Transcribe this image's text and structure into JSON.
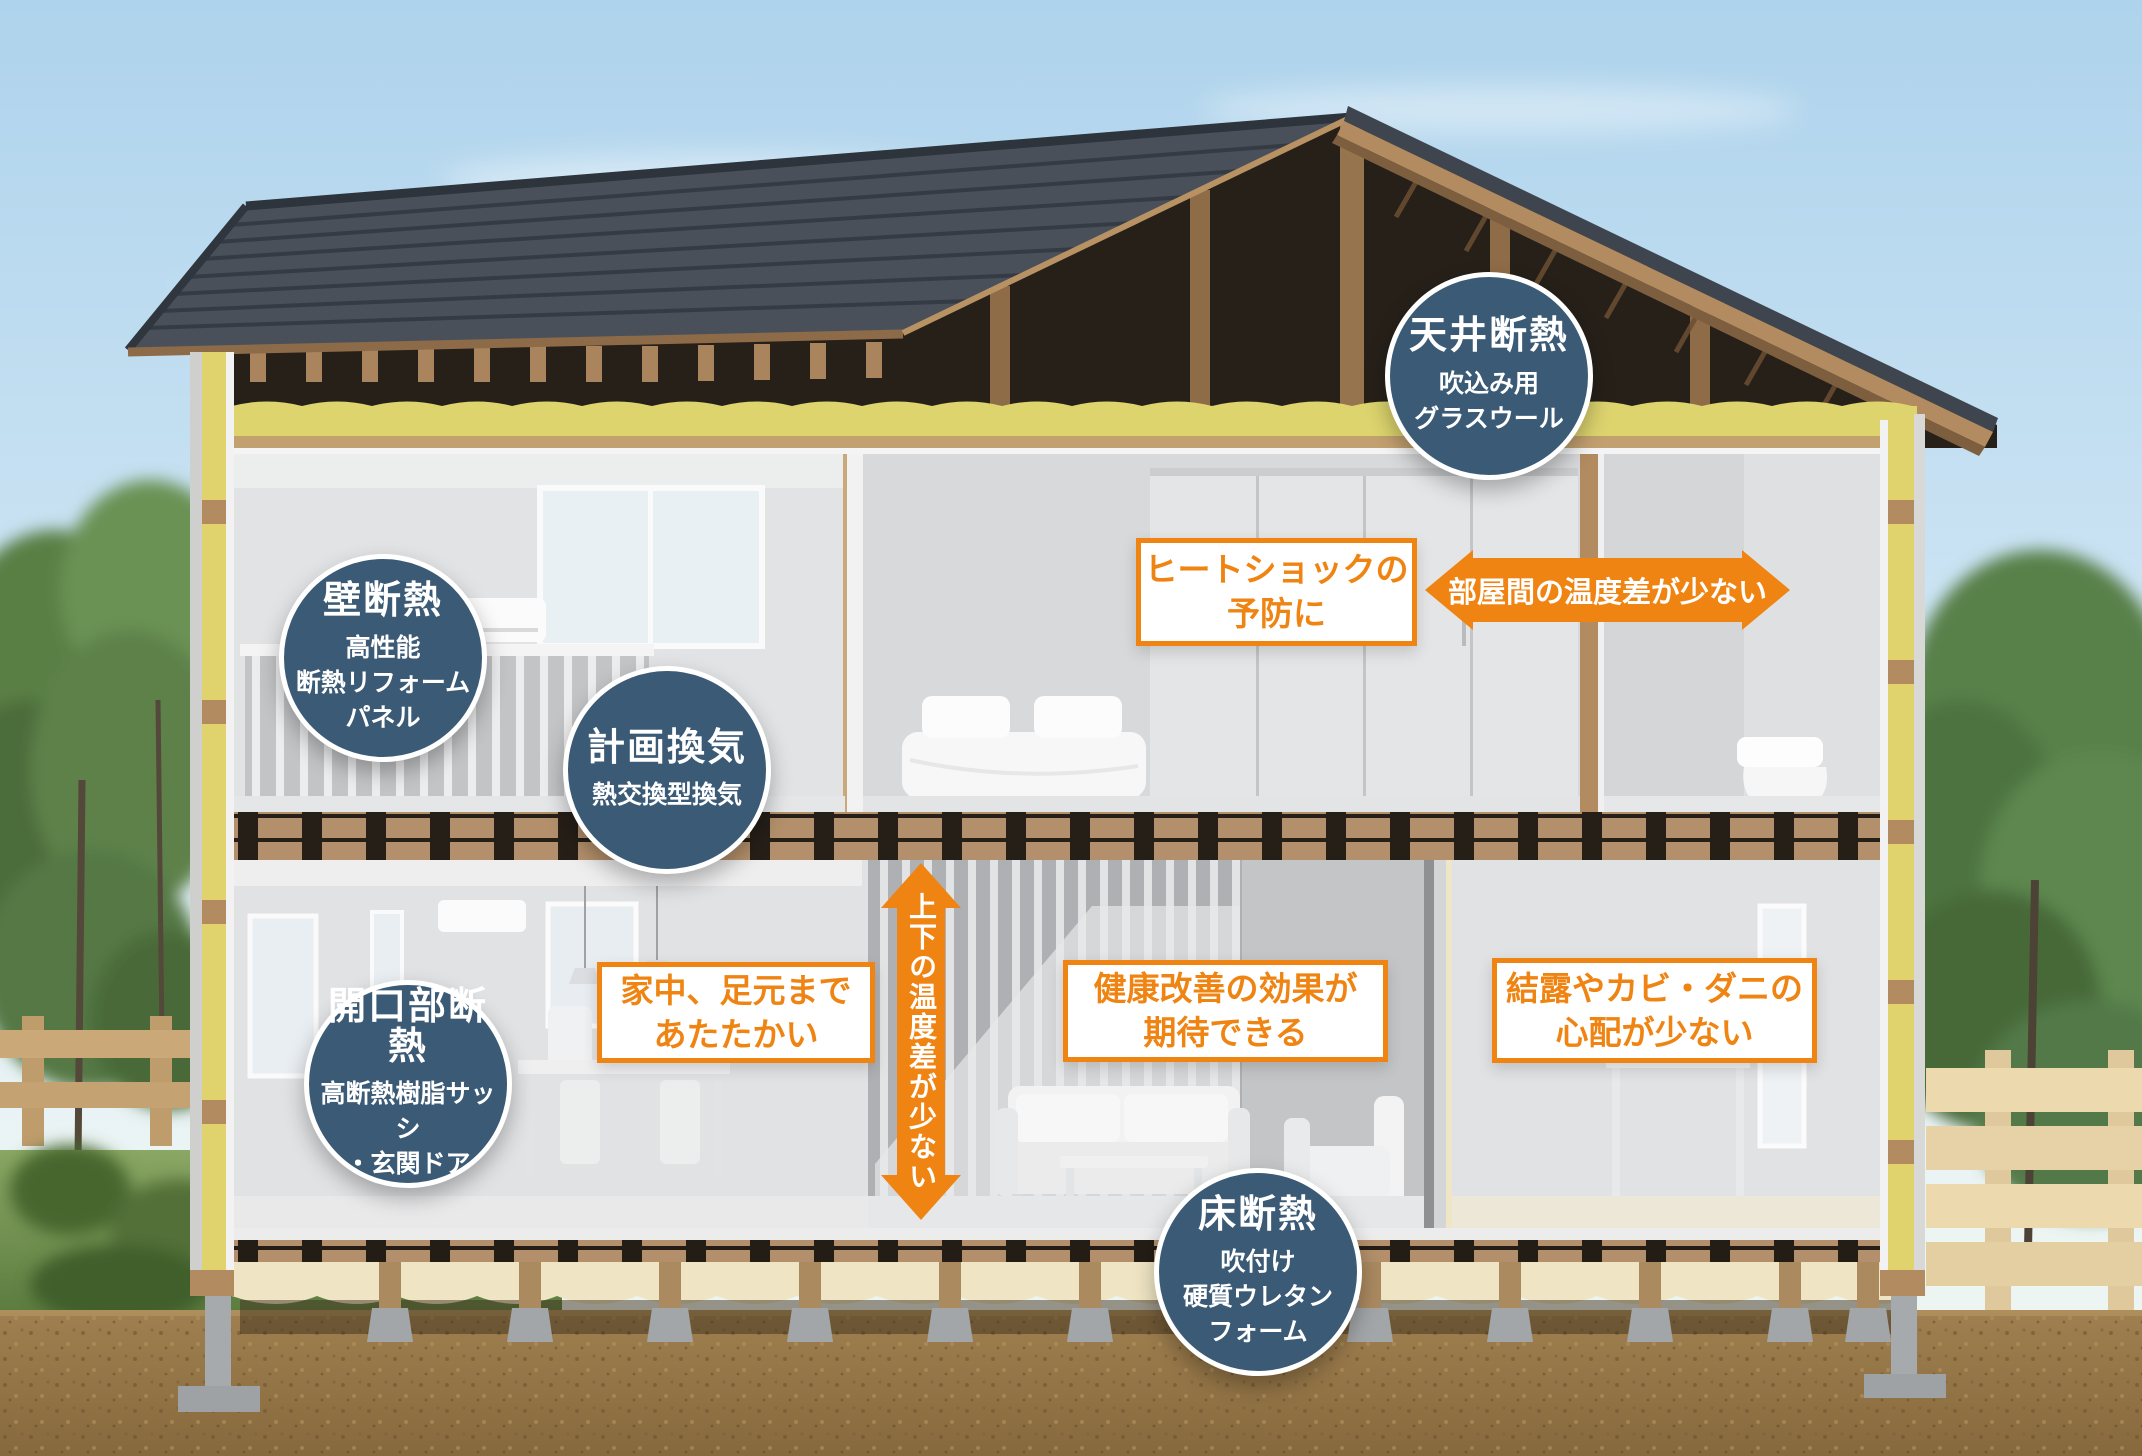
{
  "colors": {
    "accent_orange": "#ef8412",
    "circle_blue": "#3b5a76",
    "text_white": "#ffffff"
  },
  "feature_circles": [
    {
      "id": "ceiling",
      "title": "天井断熱",
      "lines": [
        "吹込み用",
        "グラスウール"
      ]
    },
    {
      "id": "wall",
      "title": "壁断熱",
      "lines": [
        "高性能",
        "断熱リフォーム",
        "パネル"
      ]
    },
    {
      "id": "ventilation",
      "title": "計画換気",
      "lines": [
        "熱交換型換気"
      ]
    },
    {
      "id": "opening",
      "title": "開口部断熱",
      "lines": [
        "高断熱樹脂サッシ",
        "・玄関ドア"
      ]
    },
    {
      "id": "floor",
      "title": "床断熱",
      "lines": [
        "吹付け",
        "硬質ウレタン",
        "フォーム"
      ]
    }
  ],
  "benefit_boxes": [
    {
      "id": "heat-shock",
      "lines": [
        "ヒートショックの",
        "予防に"
      ]
    },
    {
      "id": "warm-feet",
      "lines": [
        "家中、足元まで",
        "あたたかい"
      ]
    },
    {
      "id": "health",
      "lines": [
        "健康改善の効果が",
        "期待できる"
      ]
    },
    {
      "id": "condensation",
      "lines": [
        "結露やカビ・ダニの",
        "心配が少ない"
      ]
    }
  ],
  "arrows": [
    {
      "id": "room-to-room",
      "label": "部屋間の温度差が少ない"
    },
    {
      "id": "floor-to-ceil",
      "label": "上下の温度差が少ない"
    }
  ]
}
